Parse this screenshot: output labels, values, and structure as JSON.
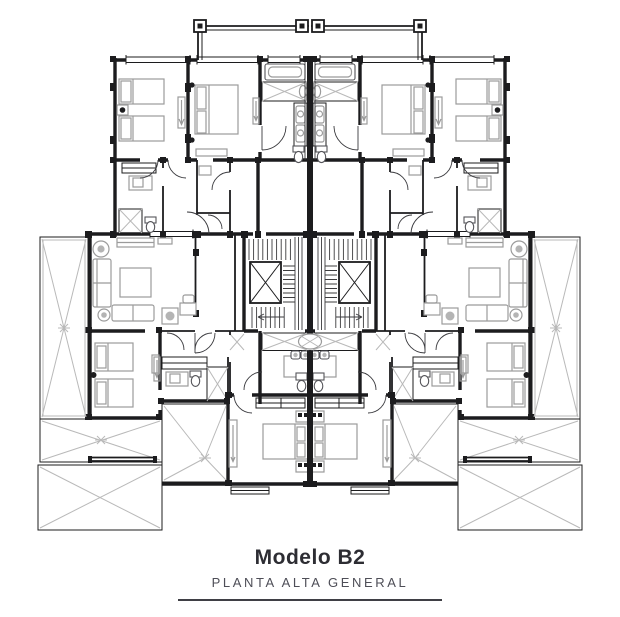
{
  "plan": {
    "title": "Modelo B2",
    "subtitle": "PLANTA ALTA GENERAL"
  },
  "colors": {
    "background": "#ffffff",
    "walls": "#1c1c1e",
    "furniture": "#9b9b9b",
    "terrace_lines": "#b9b9b9",
    "stair_lines": "#3c3c3e",
    "title_text": "#2d2d33",
    "subtitle_text": "#4e4e57",
    "caption_rule": "#3f3f45"
  }
}
